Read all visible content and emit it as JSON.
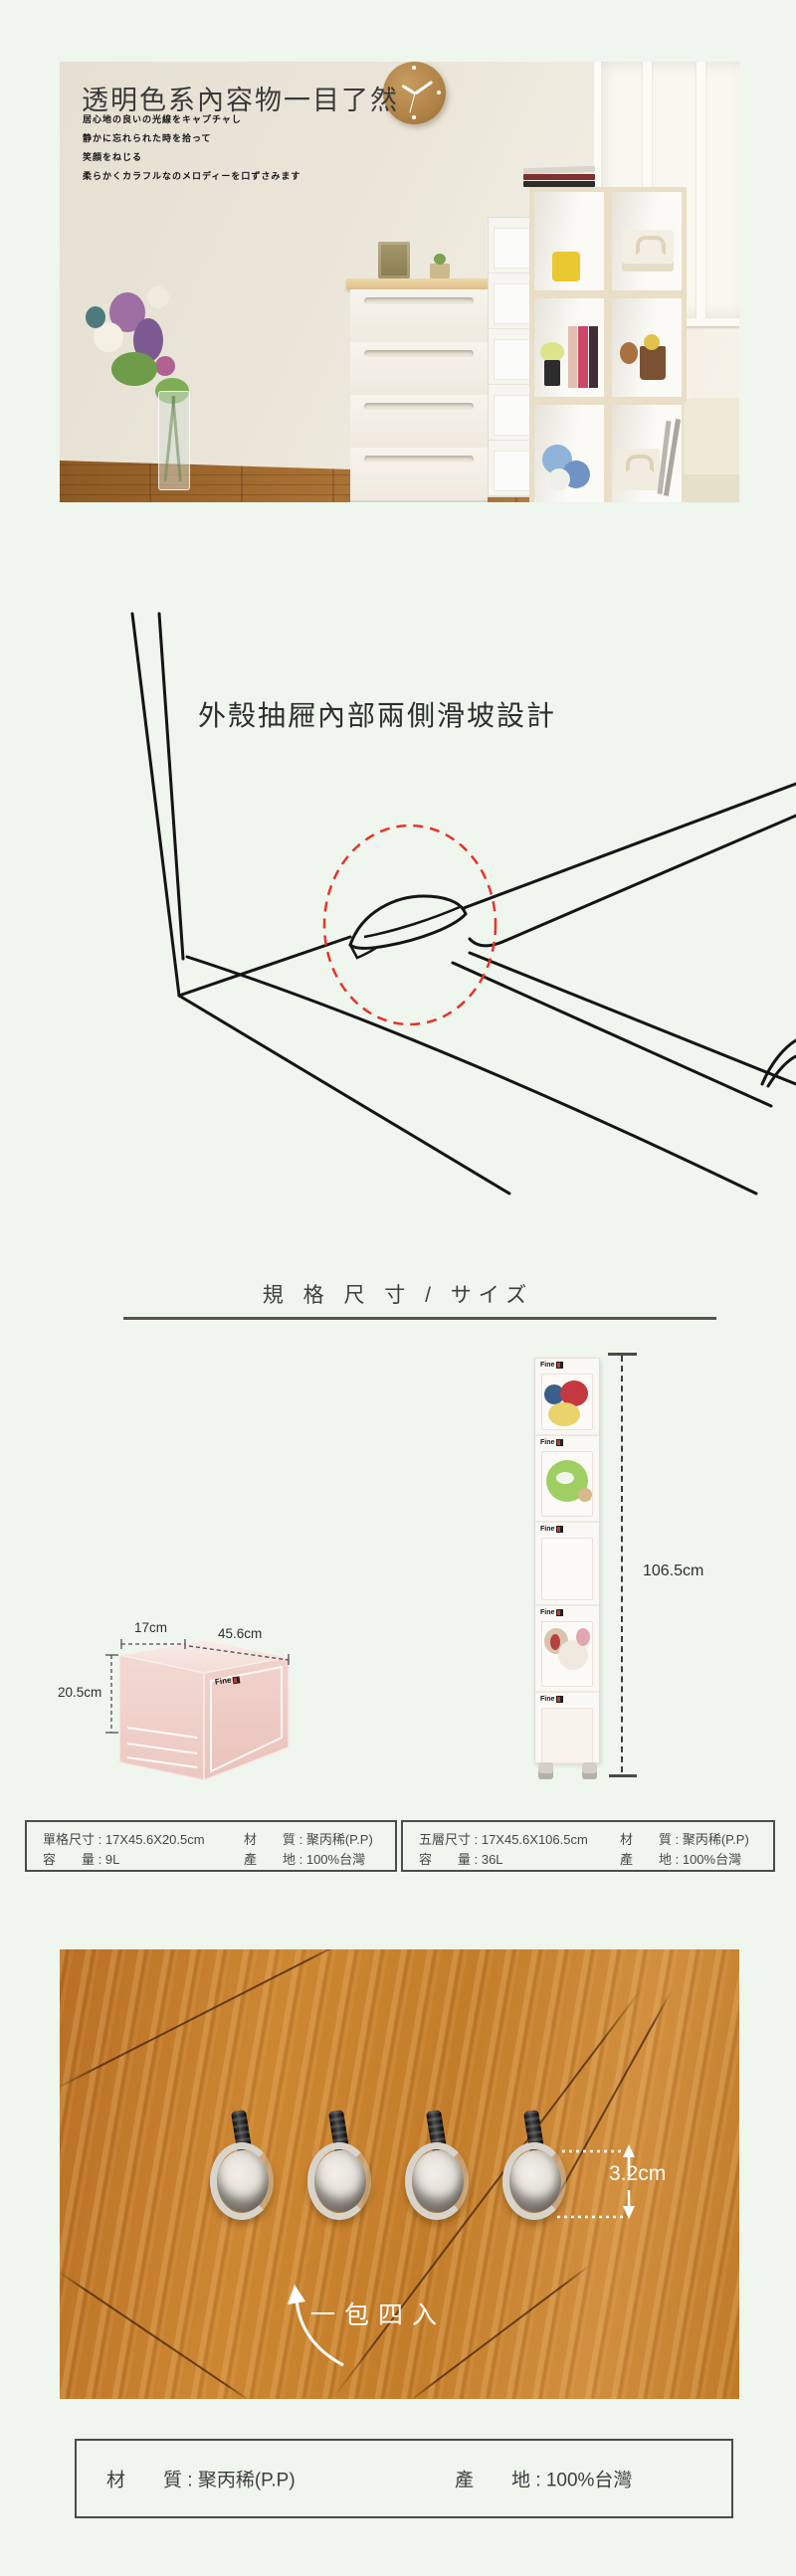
{
  "brand": {
    "logo": "Fine"
  },
  "hero": {
    "title": "透明色系內容物一目了然",
    "subtitle_lines": [
      "居心地の良いの光線をキャプチャし",
      "静かに忘れられた時を拾って",
      "笑顔をねじる",
      "柔らかくカラフルなのメロディーを口ずさみます"
    ]
  },
  "feature": {
    "caption": "外殼抽屜內部兩側滑坡設計"
  },
  "specs": {
    "heading": "規 格 尺 寸 / サイズ",
    "single_box": {
      "width": "17cm",
      "depth": "45.6cm",
      "height": "20.5cm"
    },
    "tower": {
      "height": "106.5cm"
    },
    "tables": [
      {
        "rows": [
          [
            "單格尺寸 : 17X45.6X20.5cm",
            "材　　質 : 聚丙稀(P.P)"
          ],
          [
            "容　　量 : 9L",
            "產　　地 : 100%台灣"
          ]
        ]
      },
      {
        "rows": [
          [
            "五層尺寸 : 17X45.6X106.5cm",
            "材　　質 : 聚丙稀(P.P)"
          ],
          [
            "容　　量 : 36L",
            "產　　地 : 100%台灣"
          ]
        ]
      }
    ]
  },
  "wheels": {
    "height_label": "3.2cm",
    "pack_label": "一包四入"
  },
  "footer": {
    "material": "材　　質 : 聚丙稀(P.P)",
    "origin": "產　　地 : 100%台灣"
  },
  "colors": {
    "accent_red": "#e63329",
    "page_bg": "#eef6ee",
    "wood_floor": "#c9832f"
  }
}
